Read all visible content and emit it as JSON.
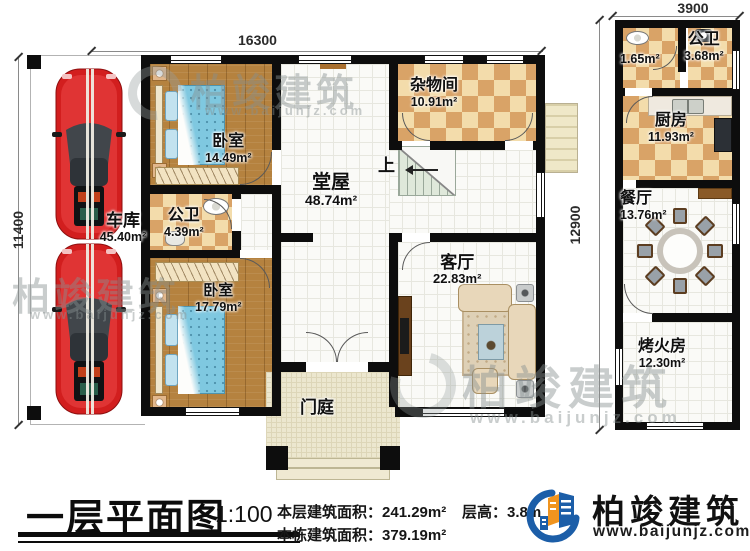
{
  "title": {
    "text": "一层平面图",
    "scale": "1:100"
  },
  "dimensions": {
    "top": "16300",
    "left": "11400",
    "right": "12900",
    "annex_top": "3900"
  },
  "rooms": {
    "garage": {
      "name": "车库",
      "area": "45.40m²"
    },
    "bedroom1": {
      "name": "卧室",
      "area": "14.49m²"
    },
    "bath1": {
      "name": "公卫",
      "area": "4.39m²"
    },
    "bedroom2": {
      "name": "卧室",
      "area": "17.79m²"
    },
    "hall": {
      "name": "堂屋",
      "area": "48.74m²"
    },
    "storage": {
      "name": "杂物间",
      "area": "10.91m²"
    },
    "living": {
      "name": "客厅",
      "area": "22.83m²"
    },
    "porch": {
      "name": "门庭",
      "area": ""
    },
    "annex_room_small": {
      "name": "",
      "area": "1.65m²"
    },
    "annex_bath": {
      "name": "公卫",
      "area": "3.68m²"
    },
    "kitchen": {
      "name": "厨房",
      "area": "11.93m²"
    },
    "dining": {
      "name": "餐厅",
      "area": "13.76m²"
    },
    "fire_room": {
      "name": "烤火房",
      "area": "12.30m²"
    }
  },
  "stairs": {
    "up": "上"
  },
  "footer": {
    "floor_area_label": "本层建筑面积：",
    "floor_area_value": "241.29m²",
    "building_area_label": "本栋建筑面积：",
    "building_area_value": "379.19m²",
    "floor_height_label": "层高：",
    "floor_height_value": "3.8m",
    "brand": "柏竣建筑",
    "website": "www.baijunjz.com"
  },
  "watermark": {
    "brand": "柏竣建筑",
    "website": "www.baijunjz.com"
  },
  "colors": {
    "wall": "#0d0d0d",
    "wood": "#b5823f",
    "checker_light": "#f3dcab",
    "checker_dark": "#d9a367",
    "bed_blue": "#7fc8e0",
    "car_red": "#d61f1f",
    "logo_blue": "#1c5ea8",
    "logo_orange": "#f0941f"
  }
}
